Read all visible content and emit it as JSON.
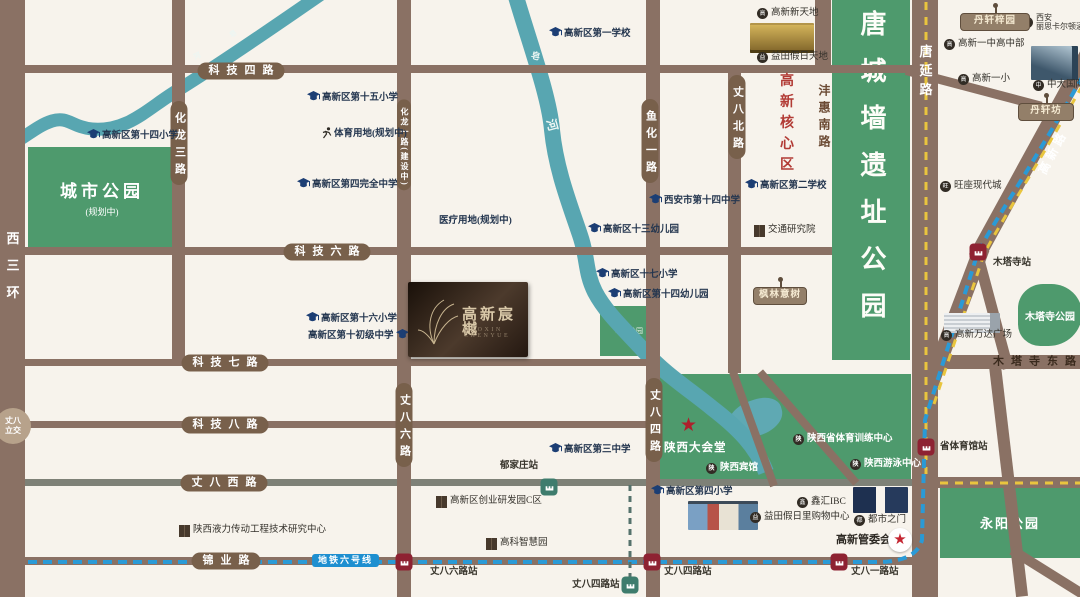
{
  "title": "高新宸樾区位图",
  "logo": {
    "title": "高新宸樾",
    "subtitle": "GAOXIN CHENYUE"
  },
  "metro": {
    "label": "地铁六号线",
    "line_color": "#2a9ad6",
    "branch_color": "#55726c",
    "road_dash_color": "#e9c53e"
  },
  "palette": {
    "road": "#8a7164",
    "road_grey": "#7e8177",
    "pill": "#78604b",
    "park": "#4e9a6d",
    "river": "#58a6b1",
    "station_red": "#8e2232",
    "station_green": "#3e7c6d",
    "school_blue": "#1c3e74",
    "accent_red": "#b23b35",
    "bg": "#f7f3ec"
  },
  "parks": {
    "city": {
      "name": "城市公园",
      "sub": "(规划中)"
    },
    "tangwall": {
      "name": "唐城墙遗址公园"
    },
    "zaohe": {
      "name": "皂河公园"
    },
    "yongyang": {
      "name": "永阳公园"
    },
    "mutasi": {
      "name": "木塔寺公园"
    }
  },
  "specials": {
    "lijiao": {
      "l1": "丈八",
      "l2": "立交"
    },
    "core_area": "高新核心区",
    "dahuitang": "陕西大会堂",
    "guanweihui": "高新管委会"
  },
  "roads": [
    {
      "n": "xisanhuan-road",
      "x": 0,
      "y": 0,
      "w": 25,
      "h": 597
    },
    {
      "n": "keji-4-road",
      "x": 25,
      "y": 65,
      "w": 890,
      "h": 8
    },
    {
      "n": "keji-6-road",
      "x": 25,
      "y": 247,
      "w": 807,
      "h": 8
    },
    {
      "n": "keji-7-road",
      "x": 25,
      "y": 359,
      "w": 630,
      "h": 7
    },
    {
      "n": "keji-8-road",
      "x": 25,
      "y": 421,
      "w": 628,
      "h": 7
    },
    {
      "n": "zhangba-west-road",
      "x": 25,
      "y": 479,
      "w": 890,
      "h": 7,
      "c": "#7e8177"
    },
    {
      "n": "jinye-road",
      "x": 25,
      "y": 557,
      "w": 888,
      "h": 8
    },
    {
      "n": "mutasi-east-road",
      "x": 938,
      "y": 355,
      "w": 142,
      "h": 14
    },
    {
      "n": "zhangba-west-ext-road",
      "x": 938,
      "y": 477,
      "w": 142,
      "h": 11
    },
    {
      "n": "hualong-3-road",
      "x": 172,
      "y": 0,
      "w": 13,
      "h": 362
    },
    {
      "n": "hualong-1-zhangba-6-road",
      "x": 397,
      "y": 0,
      "w": 14,
      "h": 597
    },
    {
      "n": "yuhua-1-zhangba-4-road",
      "x": 646,
      "y": 0,
      "w": 14,
      "h": 597
    },
    {
      "n": "zhangba-north-road",
      "x": 728,
      "y": 70,
      "w": 13,
      "h": 303
    },
    {
      "n": "fenghui-south-road",
      "x": 815,
      "y": 0,
      "w": 16,
      "h": 70
    },
    {
      "n": "tangyan-road",
      "x": 912,
      "y": 0,
      "w": 26,
      "h": 597
    },
    {
      "n": "gaoxin-road-lower",
      "x": 920,
      "y": 404,
      "w": 175,
      "h": 16,
      "rot": -69.3
    },
    {
      "n": "gaoxin-road-upper",
      "x": 976,
      "y": 250,
      "w": 242,
      "h": 16,
      "rot": -61.3
    },
    {
      "n": "mutasi-branch-road",
      "x": 977,
      "y": 247,
      "w": 120,
      "h": 11,
      "rot": 75
    },
    {
      "n": "south-branch-road",
      "x": 995,
      "y": 360,
      "w": 232,
      "h": 12,
      "rot": 83.3
    },
    {
      "n": "se-branch-road",
      "x": 1012,
      "y": 545,
      "w": 94,
      "h": 10,
      "rot": 32
    },
    {
      "n": "top-connector-road",
      "x": 906,
      "y": 66,
      "w": 140,
      "h": 9,
      "rot": 14.8
    },
    {
      "n": "green-diagonal-a-road",
      "x": 733,
      "y": 368,
      "w": 121,
      "h": 8,
      "rot": 70.2
    },
    {
      "n": "green-diagonal-b-road",
      "x": 760,
      "y": 368,
      "w": 147,
      "h": 8,
      "rot": 49.1
    }
  ],
  "pills_h": [
    {
      "text": "科技四路",
      "cx": 241,
      "cy": 71
    },
    {
      "text": "科技六路",
      "cx": 327,
      "cy": 252
    },
    {
      "text": "科技七路",
      "cx": 225,
      "cy": 363
    },
    {
      "text": "科技八路",
      "cx": 225,
      "cy": 425
    },
    {
      "text": "丈八西路",
      "cx": 224,
      "cy": 483
    },
    {
      "text": "锦业路",
      "cx": 226,
      "cy": 561
    }
  ],
  "pills_v": [
    {
      "text": "化龙三路",
      "cx": 179,
      "cy": 143
    },
    {
      "text": "化龙一路(建设中)",
      "cx": 404,
      "cy": 145,
      "small": true
    },
    {
      "text": "鱼化一路",
      "cx": 650,
      "cy": 141
    },
    {
      "text": "丈八北路",
      "cx": 737,
      "cy": 117
    },
    {
      "text": "丈八六路",
      "cx": 404,
      "cy": 425
    },
    {
      "text": "丈八四路",
      "cx": 654,
      "cy": 420
    }
  ],
  "road_texts": [
    {
      "text": "西三环",
      "cx": 12,
      "cy": 272,
      "mode": "v",
      "color": "#ffffff",
      "fs": 13,
      "ls": 14
    },
    {
      "text": "沣惠南路",
      "cx": 824,
      "cy": 118,
      "mode": "v",
      "color": "#6b4a33",
      "fs": 12,
      "ls": 5
    },
    {
      "text": "唐延路",
      "cx": 925,
      "cy": 73,
      "mode": "v",
      "color": "#ffffff",
      "fs": 13,
      "ls": 6
    },
    {
      "text": "高新路",
      "cx": 1053,
      "cy": 152,
      "mode": "rot",
      "rot": -62,
      "color": "#ffffff",
      "fs": 12,
      "ls": 4
    },
    {
      "text": "木塔寺东路",
      "cx": 1038,
      "cy": 362,
      "mode": "h",
      "color": "#3a2a1d",
      "fs": 11,
      "ls": 7
    },
    {
      "text": "高新核心区",
      "cx": 785,
      "cy": 125,
      "mode": "v",
      "color": "#b23b35",
      "fs": 14,
      "ls": 7
    }
  ],
  "river_labels": [
    {
      "ch": "皂",
      "x": 230,
      "y": 31,
      "rot": -35,
      "fs": 7
    },
    {
      "ch": "河",
      "x": 194,
      "y": 53,
      "rot": -28,
      "fs": 7
    },
    {
      "ch": "皂",
      "x": 531,
      "y": 52,
      "rot": 15,
      "fs": 9
    },
    {
      "ch": "河",
      "x": 546,
      "y": 119,
      "rot": 75,
      "fs": 12
    }
  ],
  "stations": [
    {
      "name": "丈八六路站",
      "x": 404,
      "y": 562,
      "type": "red",
      "lx": 430,
      "ly": 568
    },
    {
      "name": "丈八四路站",
      "x": 652,
      "y": 562,
      "type": "red",
      "lx": 664,
      "ly": 568
    },
    {
      "name": "丈八一路站",
      "x": 839,
      "y": 562,
      "type": "red",
      "lx": 851,
      "ly": 568
    },
    {
      "name": "省体育馆站",
      "x": 926,
      "y": 447,
      "type": "red",
      "lx": 940,
      "ly": 443
    },
    {
      "name": "木塔寺站",
      "x": 978,
      "y": 252,
      "type": "red",
      "lx": 993,
      "ly": 259
    },
    {
      "name": "郁家庄站",
      "x": 549,
      "y": 487,
      "type": "green",
      "lx": 500,
      "ly": 462
    },
    {
      "name": "丈八四路站",
      "x": 630,
      "y": 585,
      "type": "green",
      "lx": 572,
      "ly": 581
    }
  ],
  "schools": [
    {
      "name": "高新区第一学校",
      "x": 549,
      "y": 27
    },
    {
      "name": "高新区第十五小学",
      "x": 307,
      "y": 91
    },
    {
      "name": "高新区第十四小学",
      "x": 87,
      "y": 129
    },
    {
      "name": "体育用地(规划中)",
      "x": 322,
      "y": 127,
      "icon": "runner"
    },
    {
      "name": "高新区第四完全中学",
      "x": 297,
      "y": 178
    },
    {
      "name": "医疗用地(规划中)",
      "x": 437,
      "y": 217,
      "icon": "building"
    },
    {
      "name": "西安市第十四中学",
      "x": 649,
      "y": 194
    },
    {
      "name": "高新区第二学校",
      "x": 745,
      "y": 179
    },
    {
      "name": "高新区十三幼儿园",
      "x": 588,
      "y": 223
    },
    {
      "name": "高新区十七小学",
      "x": 596,
      "y": 268
    },
    {
      "name": "高新区第十四幼儿园",
      "x": 608,
      "y": 288
    },
    {
      "name": "高新区第十六小学",
      "x": 306,
      "y": 312
    },
    {
      "name": "高新区第十初级中学",
      "x": 308,
      "y": 329,
      "side": "right"
    },
    {
      "name": "高新区第三中学",
      "x": 549,
      "y": 443
    },
    {
      "name": "高新区第四小学",
      "x": 651,
      "y": 485
    }
  ],
  "pois_circle": [
    {
      "name": "高新新天地",
      "x": 757,
      "y": 8
    },
    {
      "name": "益田假日天地",
      "x": 757,
      "y": 52
    },
    {
      "name": "西安丽思卡尔顿酒店",
      "x": 1022,
      "y": 14,
      "lines": [
        "西安",
        "丽思卡尔顿酒店"
      ]
    },
    {
      "name": "高新一中高中部",
      "x": 944,
      "y": 39
    },
    {
      "name": "高新一小",
      "x": 958,
      "y": 74
    },
    {
      "name": "中大国际",
      "x": 1033,
      "y": 80
    },
    {
      "name": "旺座现代城",
      "x": 940,
      "y": 181
    },
    {
      "name": "高新万达广场",
      "x": 941,
      "y": 330
    },
    {
      "name": "鑫汇IBC",
      "x": 797,
      "y": 497
    },
    {
      "name": "益田假日里购物中心",
      "x": 750,
      "y": 512
    },
    {
      "name": "都市之门",
      "x": 854,
      "y": 515
    },
    {
      "name": "陕西宾馆",
      "x": 706,
      "y": 463,
      "light": true
    },
    {
      "name": "陕西省体育训练中心",
      "x": 793,
      "y": 434,
      "light": true
    },
    {
      "name": "陕西游泳中心",
      "x": 850,
      "y": 459,
      "light": true
    }
  ],
  "pois_building": [
    {
      "name": "交通研究院",
      "x": 754,
      "y": 225
    },
    {
      "name": "陕西液力传动工程技术研究中心",
      "x": 179,
      "y": 525
    },
    {
      "name": "高新区创业研发园C区",
      "x": 436,
      "y": 496
    },
    {
      "name": "高科智慧园",
      "x": 486,
      "y": 538
    }
  ],
  "signs": [
    {
      "name": "丹轩梓园",
      "x": 960,
      "y": 13,
      "w": 64
    },
    {
      "name": "丹轩坊",
      "x": 1018,
      "y": 103,
      "w": 50
    },
    {
      "name": "枫林意树",
      "x": 753,
      "y": 287,
      "w": 48
    }
  ],
  "arts": [
    {
      "kind": "gold",
      "x": 750,
      "y": 23,
      "w": 64,
      "h": 28
    },
    {
      "kind": "glass",
      "x": 1031,
      "y": 46,
      "w": 47,
      "h": 34
    },
    {
      "kind": "towers",
      "x": 853,
      "y": 487,
      "w": 55,
      "h": 26
    },
    {
      "kind": "mall",
      "x": 688,
      "y": 501,
      "w": 70,
      "h": 26
    },
    {
      "kind": "wanda",
      "x": 944,
      "y": 313,
      "w": 56,
      "h": 20
    }
  ]
}
